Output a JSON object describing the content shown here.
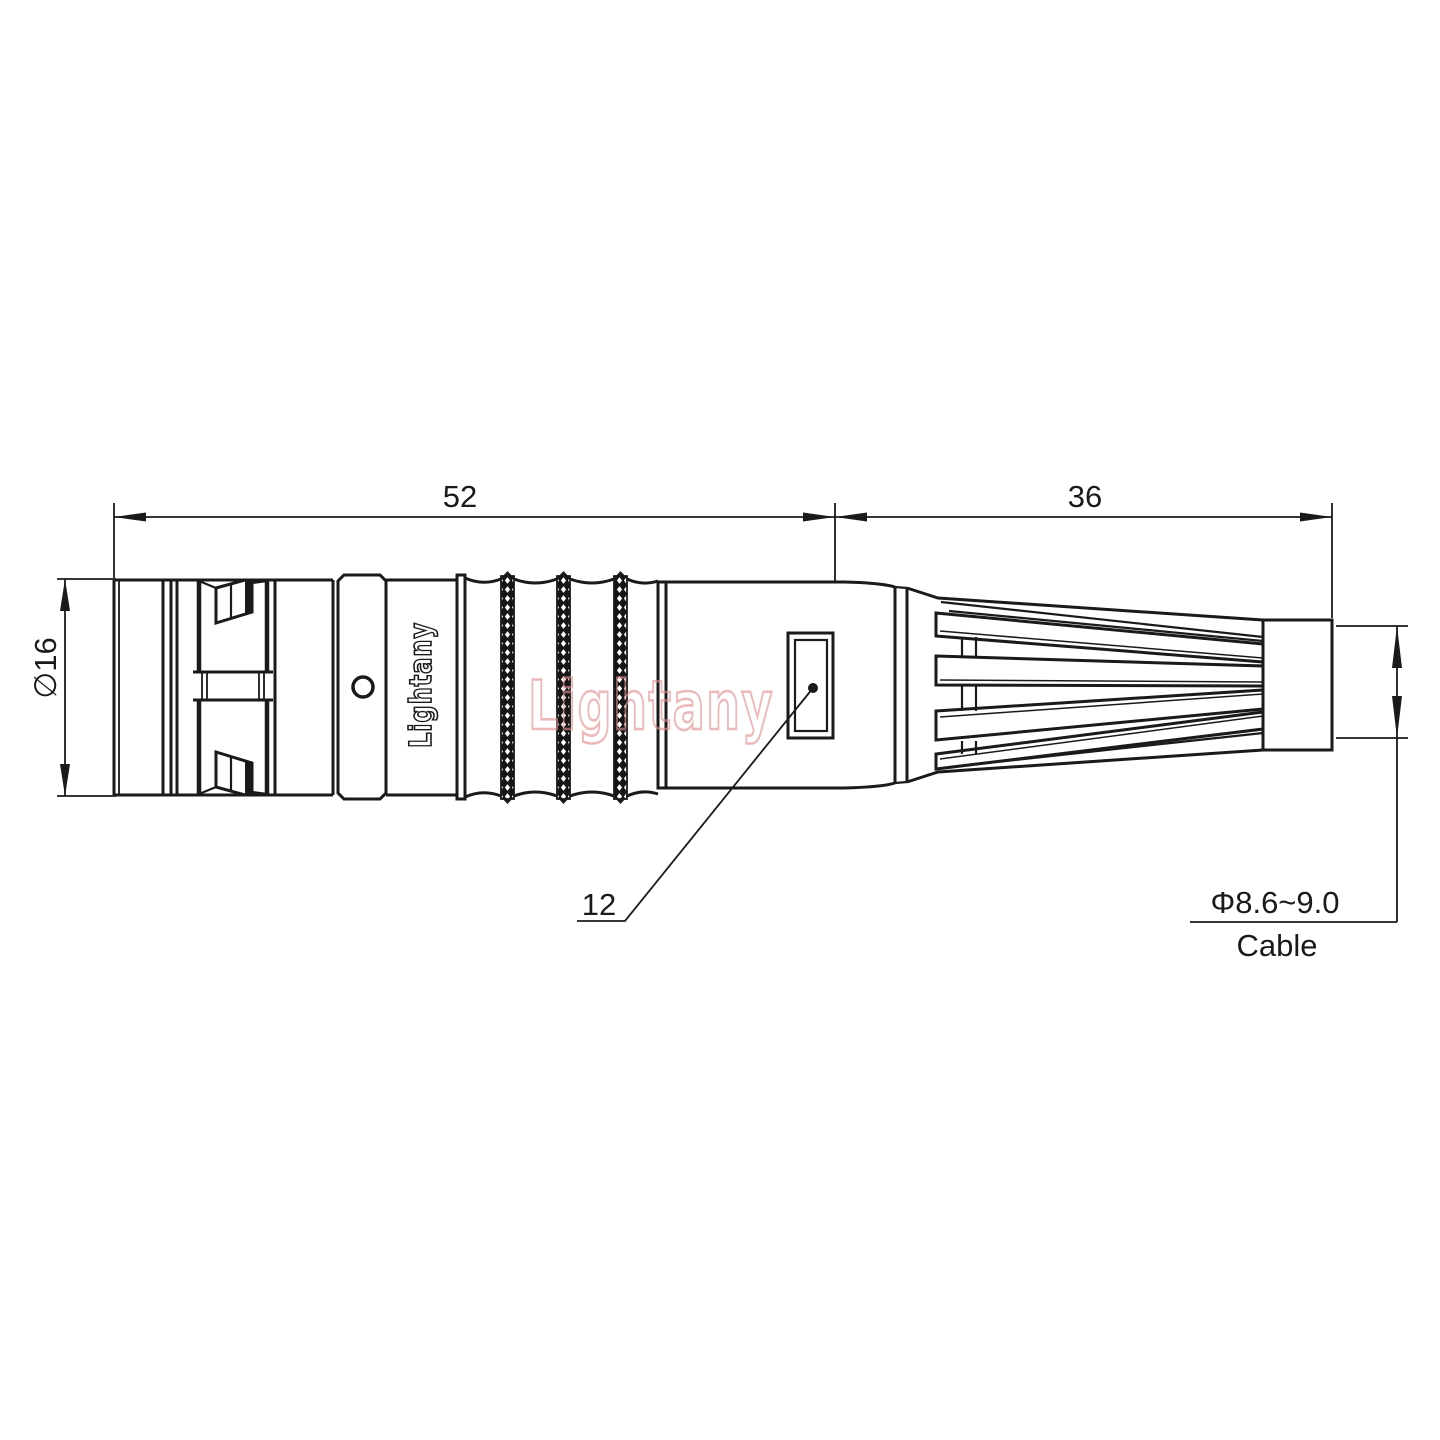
{
  "drawing": {
    "dimensions": {
      "overall_length": "52",
      "boot_length": "36",
      "shell_diameter": "∅16",
      "window_ref": "12",
      "cable_diameter": "Φ8.6~9.0",
      "cable_label": "Cable"
    },
    "branding": {
      "body_logo": "Lightany",
      "watermark": "Lightany"
    },
    "colors": {
      "line": "#1a1a1a",
      "watermark": "#e08f8f",
      "background": "#ffffff"
    }
  }
}
